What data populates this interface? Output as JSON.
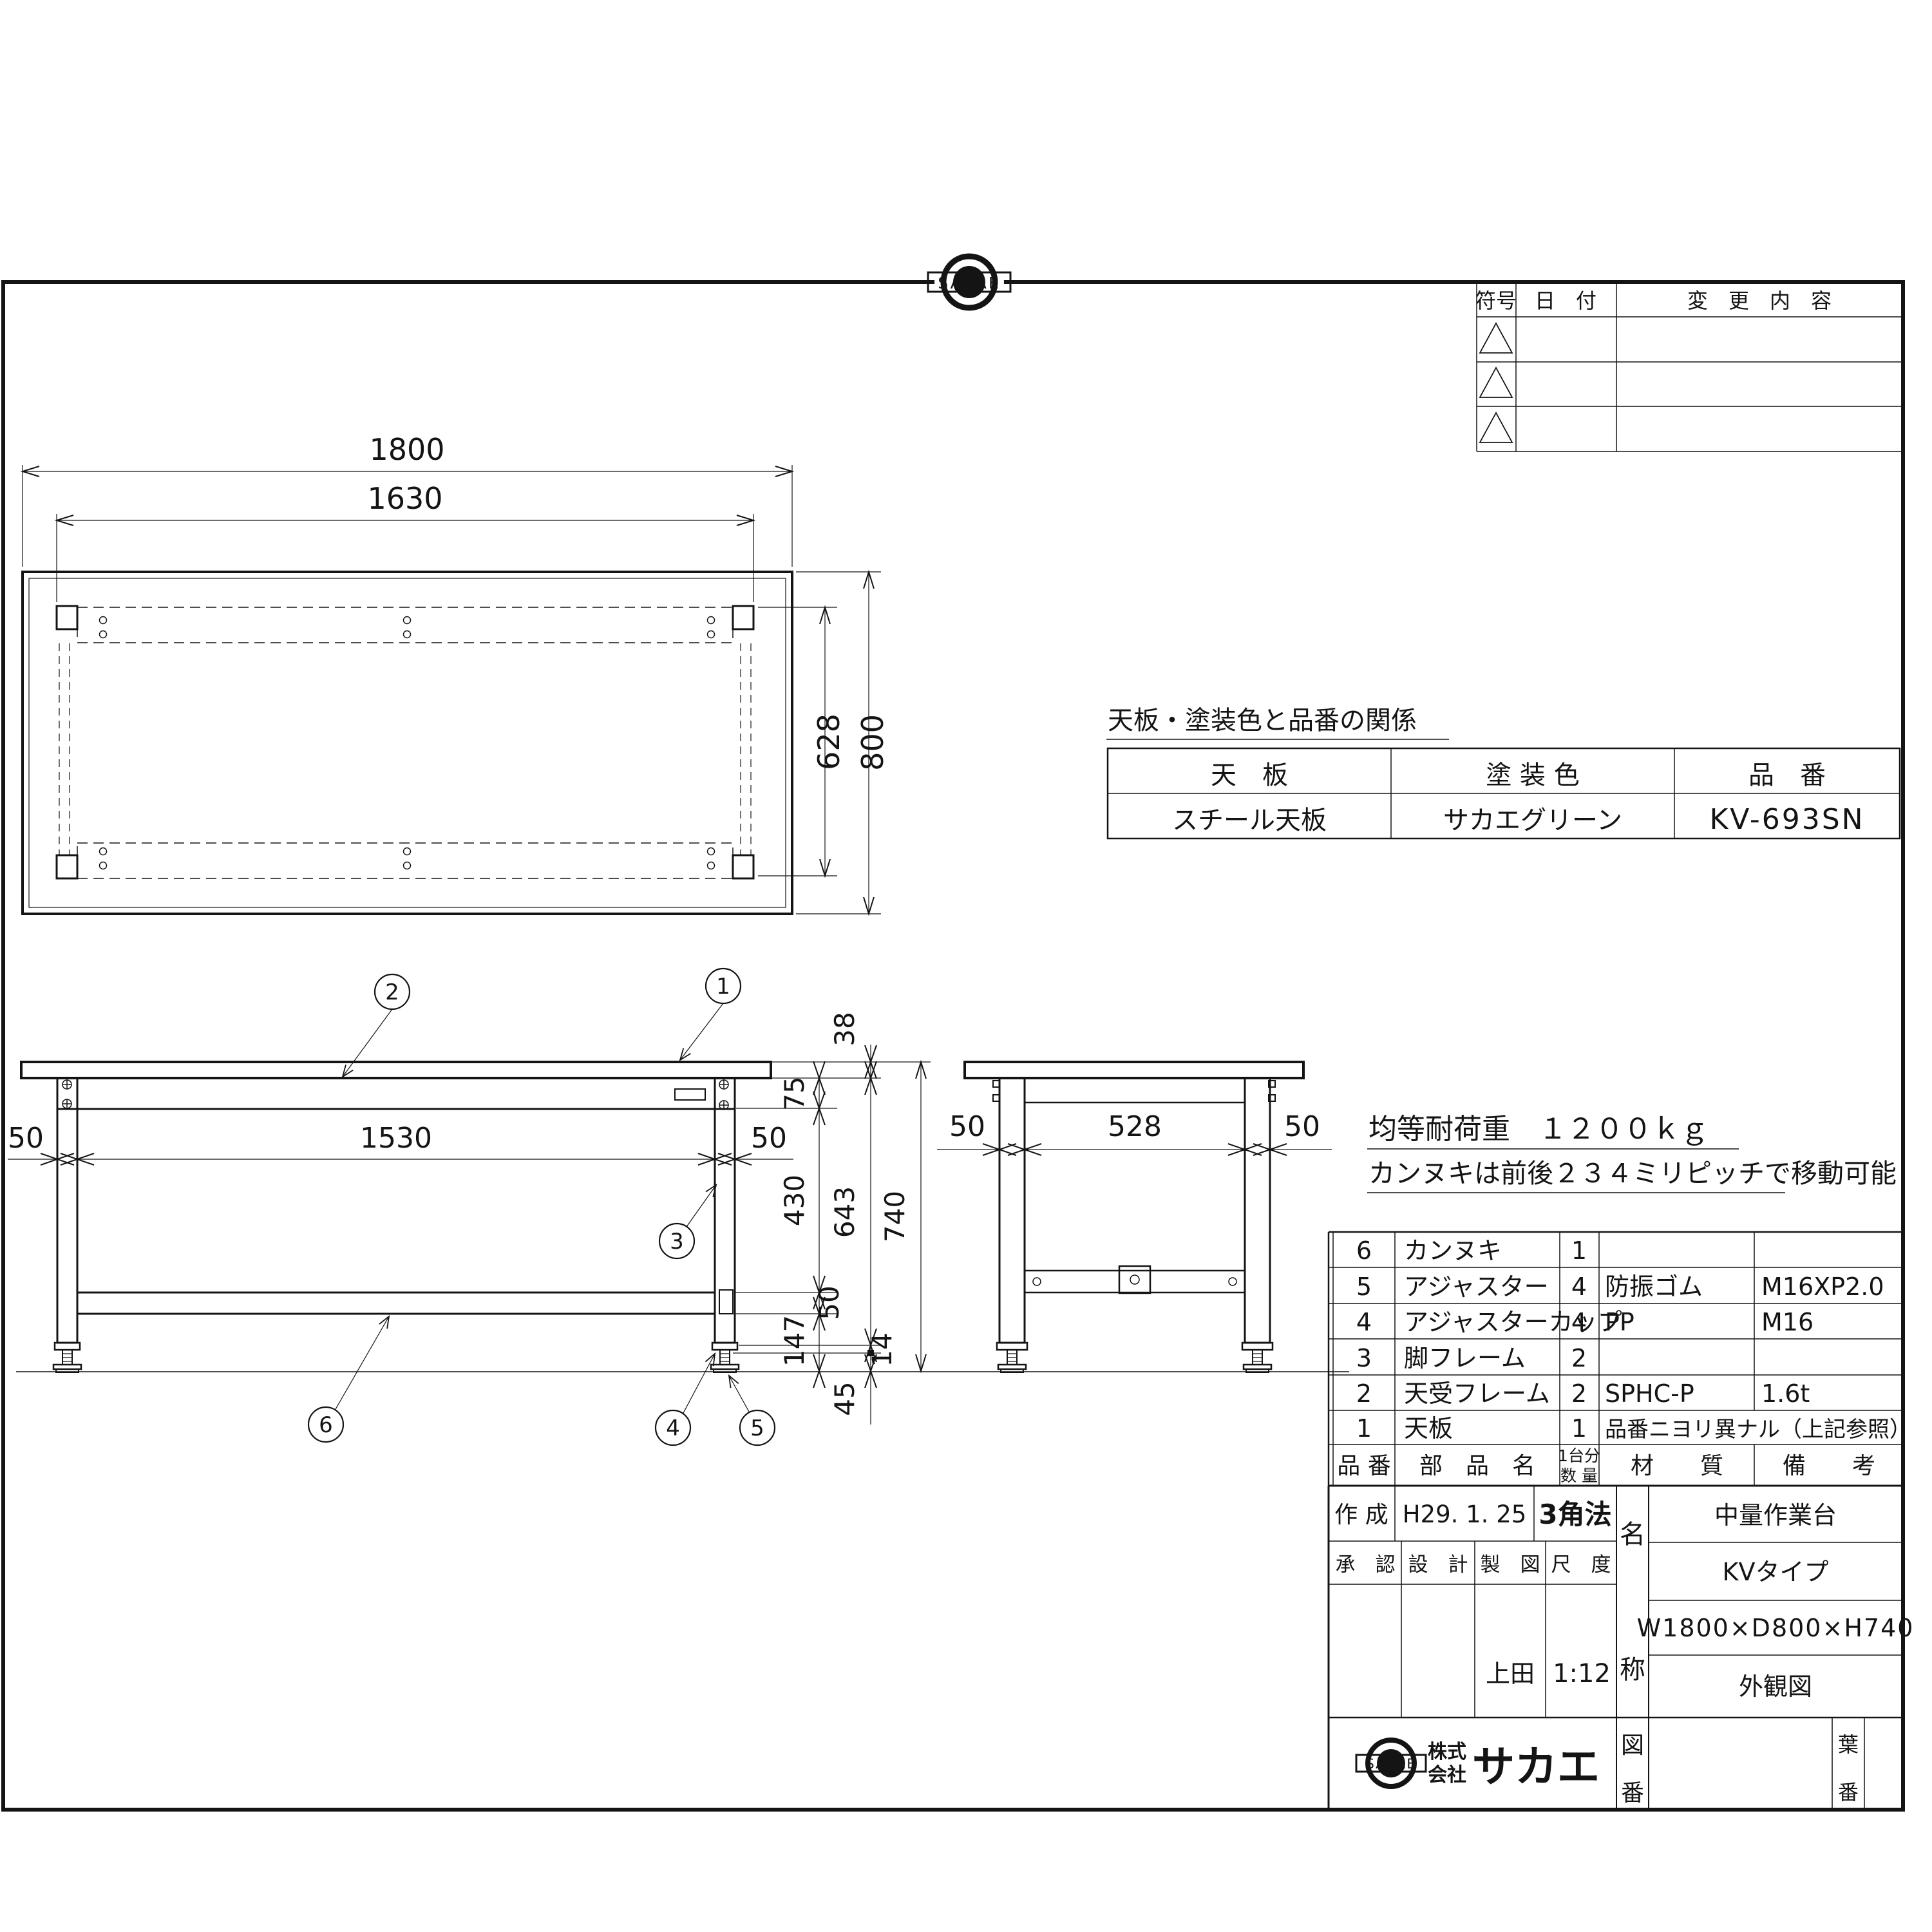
{
  "logo": {
    "text": "SAKAE",
    "company_prefix_1": "株式",
    "company_prefix_2": "会社",
    "company_name": "サカエ"
  },
  "revision_table": {
    "col_symbol": "符号",
    "col_date": "日　付",
    "col_change": "変　更　内　容"
  },
  "plan_view": {
    "dim_width": "1800",
    "dim_kannuki": "1630",
    "dim_inner_depth": "628",
    "dim_depth": "800"
  },
  "front_view": {
    "dim_leg_left": "50",
    "dim_span": "1530",
    "dim_leg_right": "50",
    "dim_top_thickness": "38",
    "dim_frame": "75",
    "dim_to_kannuki": "430",
    "dim_kannuki_h": "50",
    "dim_to_floor": "147",
    "dim_under": "643",
    "dim_adjuster_plate": "14",
    "dim_adjuster": "45",
    "dim_height": "740"
  },
  "side_view": {
    "dim_leg_left": "50",
    "dim_span": "528",
    "dim_leg_right": "50"
  },
  "balloons": {
    "b1": "1",
    "b2": "2",
    "b3": "3",
    "b4": "4",
    "b5": "5",
    "b6": "6"
  },
  "notes": {
    "load": "均等耐荷重　１２００ｋｇ",
    "pitch": "カンヌキは前後２３４ミリピッチで移動可能"
  },
  "spec_table": {
    "title": "天板・塗装色と品番の関係",
    "col_top": "天　板",
    "col_color": "塗 装 色",
    "col_part_no": "品　番",
    "row_top": "スチール天板",
    "row_color": "サカエグリーン",
    "row_part_no": "KV-693SN"
  },
  "parts_table": {
    "header": {
      "no": "品 番",
      "name": "部　品　名",
      "qty_line1": "1台分",
      "qty_line2": "数 量",
      "material": "材　　質",
      "remarks": "備　　考"
    },
    "rows": [
      {
        "no": "6",
        "name": "カンヌキ",
        "qty": "1",
        "material": "",
        "remarks": ""
      },
      {
        "no": "5",
        "name": "アジャスター",
        "qty": "4",
        "material": "防振ゴム",
        "remarks": "M16XP2.0"
      },
      {
        "no": "4",
        "name": "アジャスターカップ",
        "qty": "4",
        "material": "PP",
        "remarks": "M16"
      },
      {
        "no": "3",
        "name": "脚フレーム",
        "qty": "2",
        "material": "",
        "remarks": ""
      },
      {
        "no": "2",
        "name": "天受フレーム",
        "qty": "2",
        "material": "SPHC-P",
        "remarks": "1.6t"
      },
      {
        "no": "1",
        "name": "天板",
        "qty": "1",
        "material": "品番ニヨリ異ナル（上記参照）",
        "remarks": ""
      }
    ]
  },
  "title_block": {
    "created_label": "作 成",
    "created_value": "H29. 1. 25",
    "projection": "3角法",
    "approved_label": "承　認",
    "design_label": "設　計",
    "draft_label": "製　図",
    "scale_label": "尺　度",
    "draft_value": "上田",
    "scale_value": "1:12",
    "name_label_1": "名",
    "name_label_2": "称",
    "product_type": "中量作業台",
    "product_series": "KVタイプ",
    "product_size": "W1800×D800×H740",
    "drawing_kind": "外観図",
    "drawing_no_1": "図",
    "drawing_no_2": "番",
    "sheet_no_1": "葉",
    "sheet_no_2": "番"
  }
}
